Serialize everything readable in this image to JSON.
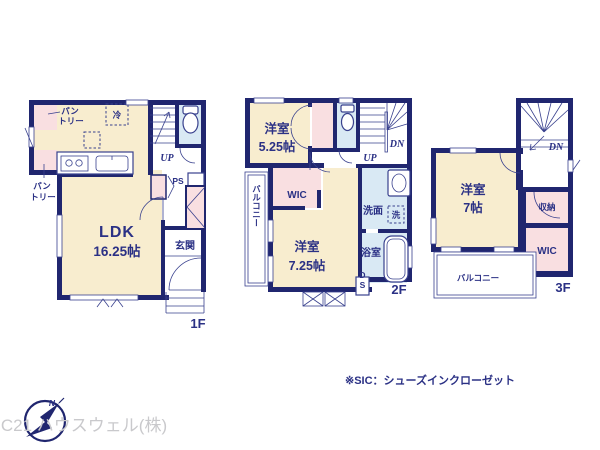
{
  "colors": {
    "wall": "#20266f",
    "room": "#f8edcf",
    "closet": "#f9dfe1",
    "wet": "#d9e9f4",
    "line": "#39418e",
    "text": "#2b3185",
    "muted": "#c9c9cc"
  },
  "floor1": {
    "name": "1F",
    "ldk": "LDK",
    "ldk_size": "16.25帖",
    "genkan": "玄関",
    "pantry_a1": "パン",
    "pantry_a2": "トリー",
    "pantry_b1": "パン",
    "pantry_b2": "トリー",
    "fridge": "冷",
    "up": "UP",
    "ps": "PS"
  },
  "floor2": {
    "name": "2F",
    "room_a": "洋室",
    "room_a_size": "5.25帖",
    "room_b": "洋室",
    "room_b_size": "7.25帖",
    "wic": "WIC",
    "balcony": "バルコニー",
    "washroom": "洗面",
    "washer": "洗",
    "bathroom": "浴室",
    "up": "UP",
    "dn": "DN",
    "ds": "DS"
  },
  "floor3": {
    "name": "3F",
    "room": "洋室",
    "room_size": "7帖",
    "storage": "収納",
    "wic": "WIC",
    "balcony": "バルコニー",
    "dn": "DN"
  },
  "footer": {
    "note": "※SIC：シューズインクローゼット",
    "company": "C21 ハウスウェル(株)",
    "compass_north": "N"
  }
}
